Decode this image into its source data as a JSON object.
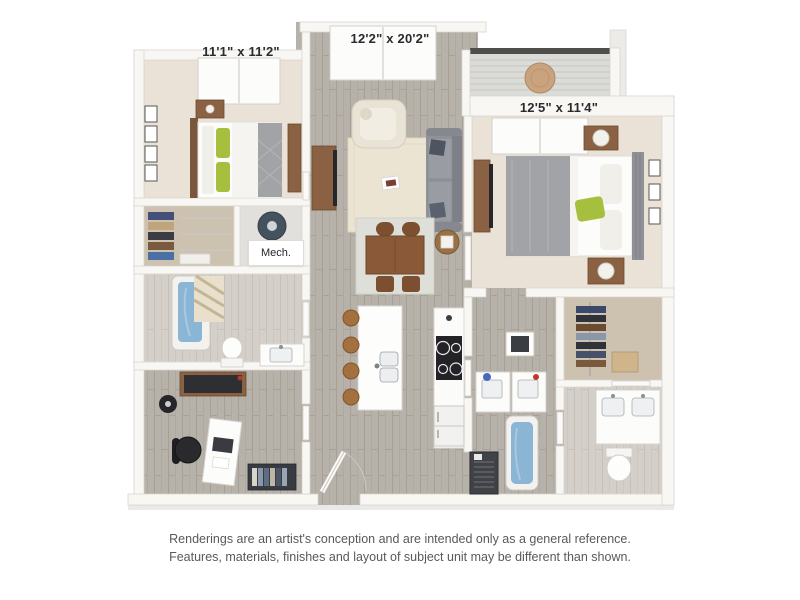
{
  "page": {
    "background_color": "#ffffff",
    "content": "apartment-floor-plan-rendering"
  },
  "floor_plan": {
    "rooms": {
      "bedroom_1": {
        "dimensions": "11'1\" x 11'2\""
      },
      "living_dining": {
        "dimensions": "12'2\" x 20'2\""
      },
      "bedroom_2": {
        "dimensions": "12'5\" x 11'4\""
      },
      "mechanical": {
        "label": "Mech."
      }
    },
    "palette": {
      "wall": "#f8f7f4",
      "wall_edge": "#d8d5cf",
      "wood_floor": "#b6b1a9",
      "light_wood_floor": "#d3cfc8",
      "carpet": "#eae2d6",
      "closet_floor": "#cdc2af",
      "balcony_deck": "#dbdbd8",
      "balcony_rail": "#504e4a",
      "accent_green": "#a6bf3e",
      "water_blue": "#8ab5d4",
      "sofa_gray": "#8f9298",
      "bedding_gray": "#a2a3a6",
      "wood_furniture": "#8a6142",
      "dark_appliance": "#232327",
      "label_text": "#2a2b2d",
      "disclaimer_text": "#58595c"
    }
  },
  "disclaimer": {
    "line_1": "Renderings are an artist's conception and are intended only as a general reference.",
    "line_2": "Features, materials, finishes and layout of subject unit may be different than shown."
  }
}
